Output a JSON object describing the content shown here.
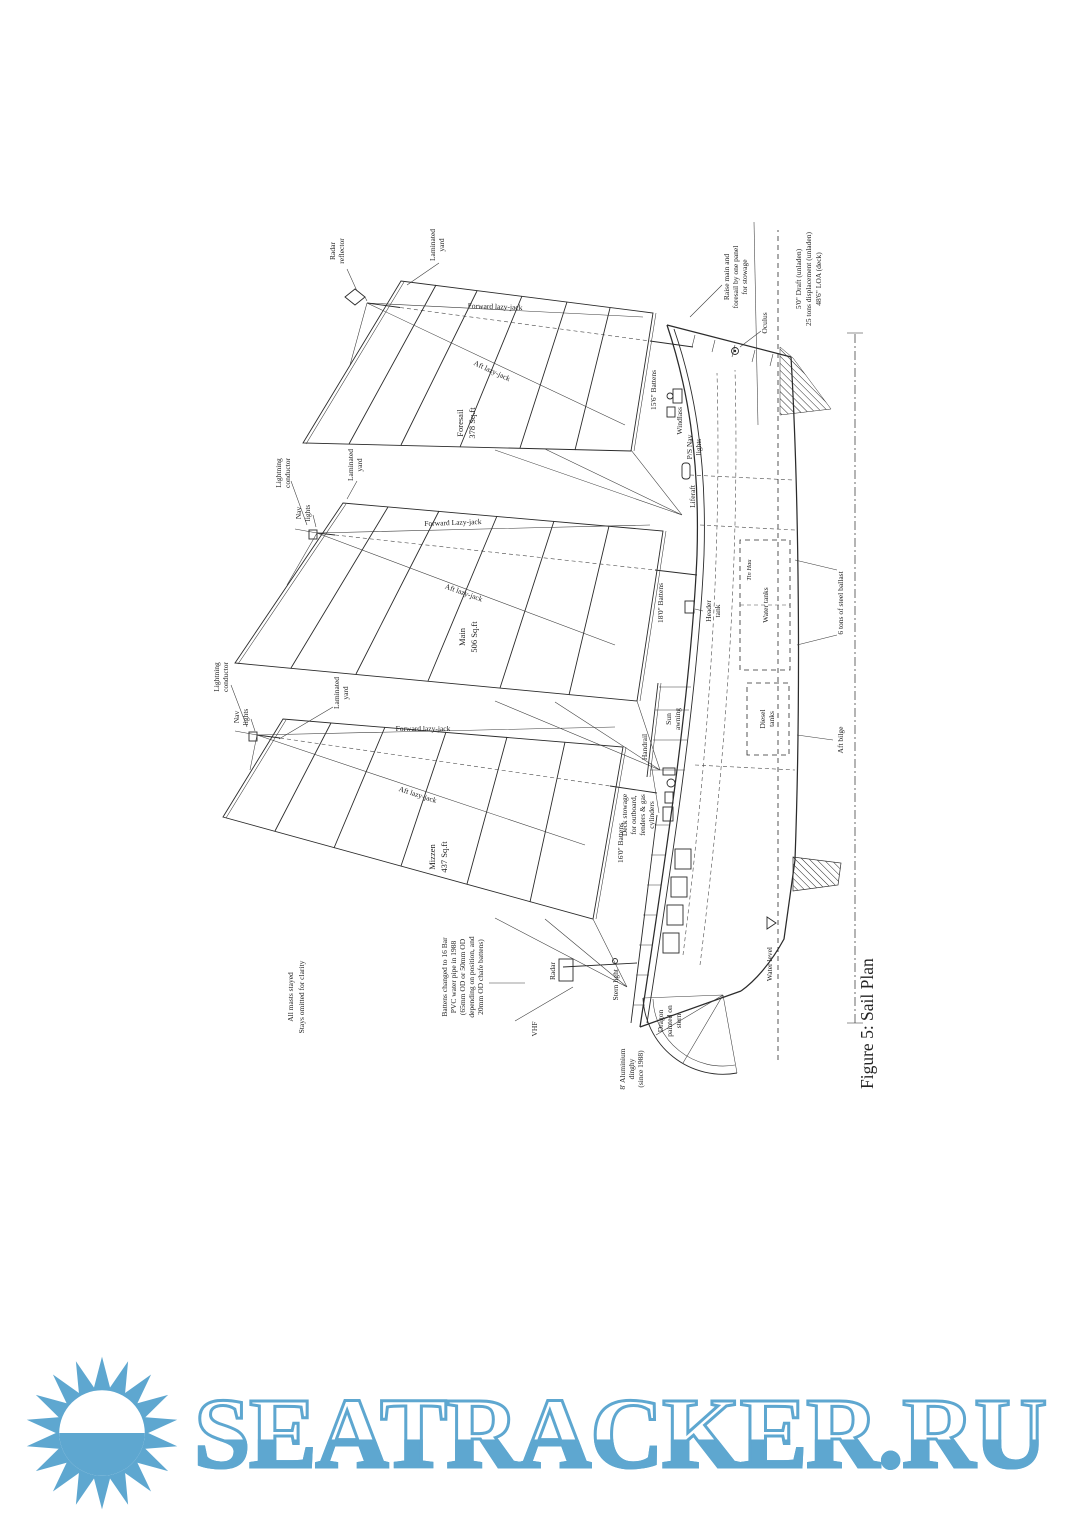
{
  "figure": {
    "caption": "Figure 5: Sail Plan",
    "boat_name": "Tin Hau",
    "masthead": {
      "radar_reflector": [
        "Radar",
        "reflector"
      ],
      "lightning_conductor": [
        "Lightning",
        "conductor"
      ],
      "nav_lights": [
        "Nav",
        "lights"
      ],
      "laminated_yard": [
        "Laminated",
        "yard"
      ]
    },
    "sails": {
      "foresail": {
        "name": "Foresail",
        "area": "378 Sq.ft",
        "battens": "15'6\" Battens",
        "fwd_lj": "Forward lazy-jack",
        "aft_lj": "Aft lazy-jack"
      },
      "main": {
        "name": "Main",
        "area": "506 Sq.ft",
        "battens": "18'0\" Battens",
        "fwd_lj": "Forward Lazy-jack",
        "aft_lj": "Aft lazy-jack"
      },
      "mizzen": {
        "name": "Mizzen",
        "area": "437 Sq.ft",
        "battens": "16'0\" Battens",
        "fwd_lj": "Forward lazy-jack",
        "aft_lj": "Aft lazy-jack"
      }
    },
    "deck": {
      "windlass": "Windlass",
      "ps_nav_lights": [
        "P/S Nav",
        "lights"
      ],
      "liferaft": "Liferaft",
      "header_tank": [
        "Header",
        "tank"
      ],
      "sun_awning": [
        "Sun",
        "awning"
      ],
      "handrail": "Handrail",
      "deck_stowage": [
        "Deck stowage",
        "for outboard,",
        "fenders & gas",
        "cylinders"
      ],
      "oculus": "Oculus"
    },
    "hull": {
      "water_tanks": "Water tanks",
      "diesel_tanks": [
        "Diesel",
        "tanks"
      ],
      "ballast": "6 tons of steel ballast",
      "aft_bilge": "Aft bilge",
      "water_level": "Water level"
    },
    "stern": {
      "radar": "Radar",
      "vhf": "VHF",
      "stern_light": "Stern light",
      "dinghy": [
        "8' Aluminium",
        "dinghy",
        "(since 1988)"
      ],
      "dragon": [
        "Dragon",
        "painted on",
        "stern"
      ]
    },
    "notes": {
      "stays": [
        "All masts stayed",
        "Stays omitted for clarity"
      ],
      "battens_note": [
        "Battens changed to 16 Bar",
        "PVC water pipe in 1988",
        "(65mm OD or 50mm OD",
        "depending on position, and",
        "20mm OD chafe battens)"
      ],
      "raise": [
        "Raise main and",
        "foresail by one panel",
        "for stowage"
      ],
      "dims": [
        "5'0\" Draft (unladen)",
        "25 tons displacement (unladen)",
        "48'6\" LOA (deck)"
      ]
    }
  },
  "logo": {
    "text": "SEATRACKER.RU",
    "color": "#5ea7d0"
  }
}
